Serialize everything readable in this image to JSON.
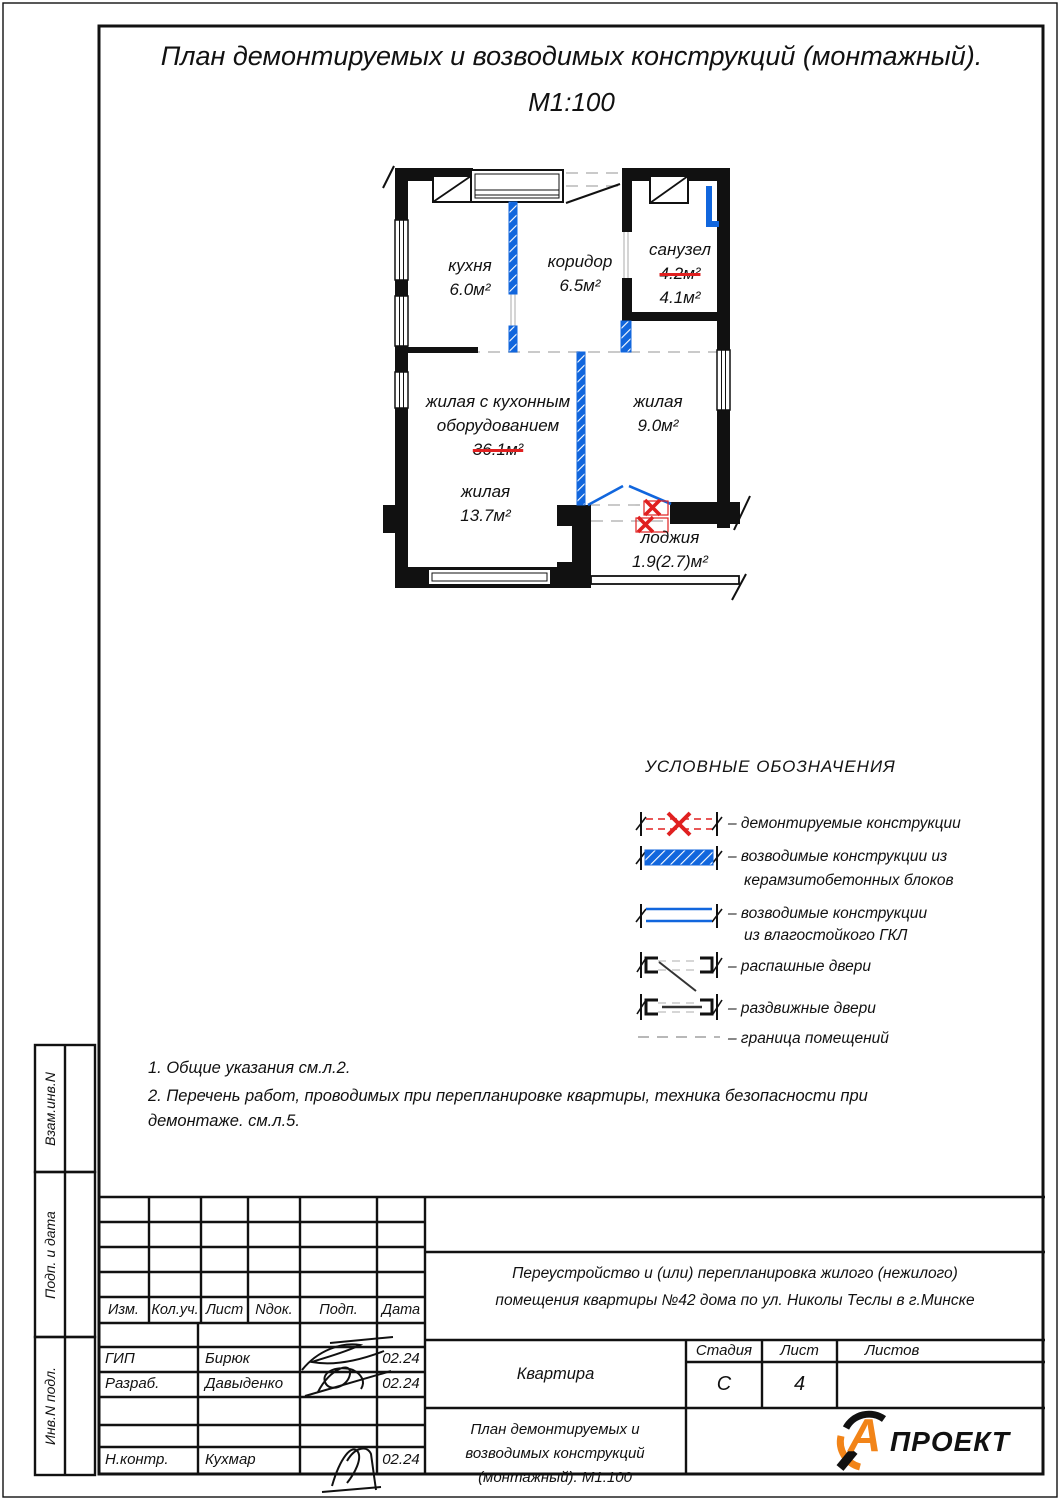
{
  "colors": {
    "accent_blue": "#1166dd",
    "demolish_red": "#e02020",
    "boundary_gray": "#bbbbbb",
    "logo_orange": "#f28418"
  },
  "title": {
    "line1": "План  демонтируемых  и  возводимых  конструкций  (монтажный).",
    "line2": "М1:100"
  },
  "plan": {
    "rooms": {
      "kitchen": {
        "name": "кухня",
        "area": "6.0м²"
      },
      "corridor": {
        "name": "коридор",
        "area": "6.5м²"
      },
      "bathroom": {
        "name": "санузел",
        "area_old": "4.2м²",
        "area_new": "4.1м²"
      },
      "living_kitchen": {
        "name_line1": "жилая с кухонным",
        "name_line2": "оборудованием",
        "area_old": "36.1м²"
      },
      "living_9": {
        "name": "жилая",
        "area": "9.0м²"
      },
      "living_13": {
        "name": "жилая",
        "area": "13.7м²"
      },
      "loggia": {
        "name": "лоджия",
        "area": "1.9(2.7)м²"
      }
    }
  },
  "legend": {
    "title": "УСЛОВНЫЕ ОБОЗНАЧЕНИЯ",
    "items": {
      "demolished": {
        "label": "–  демонтируемые конструкции"
      },
      "keramzit": {
        "line1": "–  возводимые конструкции  из",
        "line2": "керамзитобетонных блоков"
      },
      "gkl": {
        "line1": "–  возводимые конструкции",
        "line2": "из влагостойкого ГКЛ"
      },
      "swing_doors": {
        "label": "–  распашные двери"
      },
      "sliding_doors": {
        "label": "–  раздвижные двери"
      },
      "boundary": {
        "label": "–  граница помещений"
      }
    }
  },
  "notes": {
    "n1": "1.  Общие указания см.л.2.",
    "n2": "2.  Перечень работ,  проводимых при  перепланировке  квартиры,  техника  безопасности при демонтаже.  см.л.5."
  },
  "titleblock": {
    "cols": {
      "izm": "Изм.",
      "koluch": "Кол.уч.",
      "list": "Лист",
      "ndok": "Nдок.",
      "podp": "Подп.",
      "data": "Дата"
    },
    "rows": {
      "gip": {
        "role": "ГИП",
        "name": "Бирюк",
        "date": "02.24"
      },
      "razrab": {
        "role": "Разраб.",
        "name": "Давыденко",
        "date": "02.24"
      },
      "nkontr": {
        "role": "Н.контр.",
        "name": "Кухмар",
        "date": "02.24"
      }
    },
    "project": "Переустройство и (или) перепланировка жилого (нежилого) помещения квартиры №42 дома по ул. Николы Теслы в г.Минске",
    "object_name": "Квартира",
    "stage_label": "Стадия",
    "sheet_label": "Лист",
    "sheets_label": "Листов",
    "stage": "С",
    "sheet": "4",
    "sheets": "",
    "doc_title": "План демонтируемых и возводимых конструкций (монтажный). М1:100",
    "logo_letter": "А",
    "logo_text": "ПРОЕКТ"
  },
  "sidebar": {
    "vzam": "Взам.инв.N",
    "podp_data": "Подп. и дата",
    "inv": "Инв.N подл."
  }
}
